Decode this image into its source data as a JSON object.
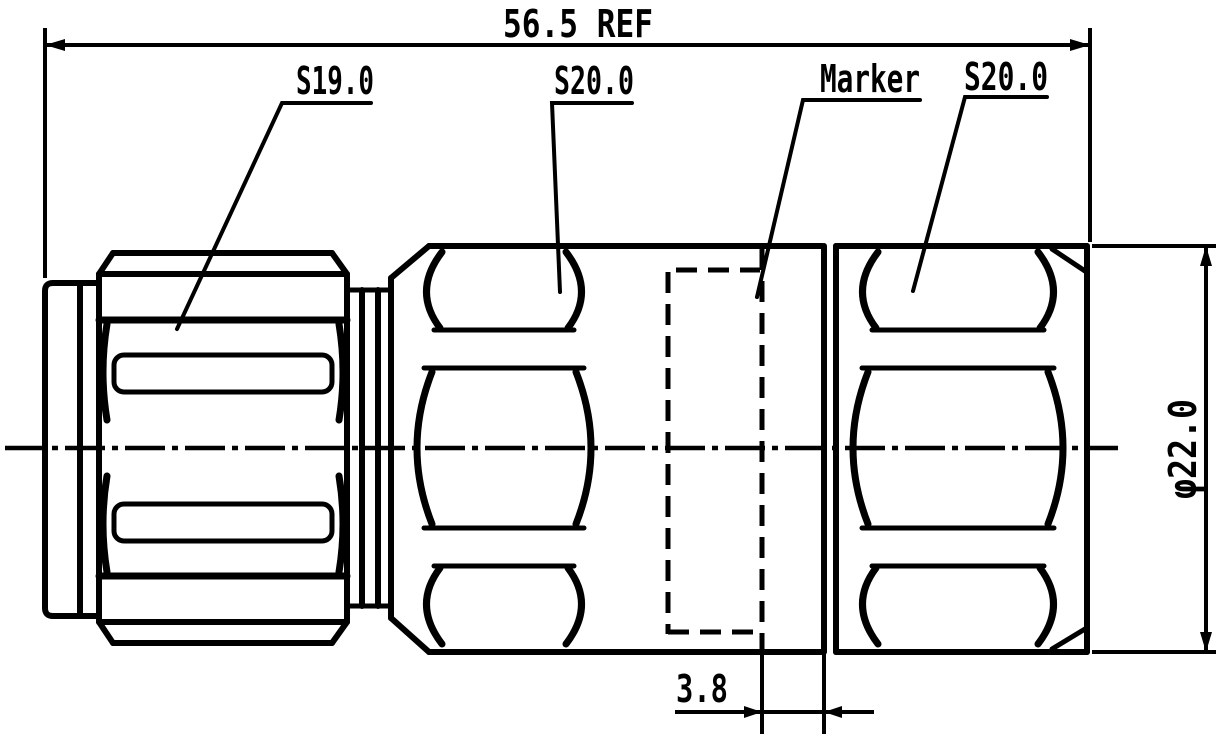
{
  "colors": {
    "background": "#ffffff",
    "line": "#000000"
  },
  "dimensions": {
    "overall_length": {
      "label": "56.5 REF"
    },
    "hex_flat_s19": {
      "label": "S19.0"
    },
    "hex_flat_s20_mid": {
      "label": "S20.0"
    },
    "marker": {
      "label": "Marker"
    },
    "hex_flat_s20_right": {
      "label": "S20.0"
    },
    "outer_diameter": {
      "label": "φ22.0"
    },
    "marker_offset": {
      "label": "3.8"
    }
  }
}
